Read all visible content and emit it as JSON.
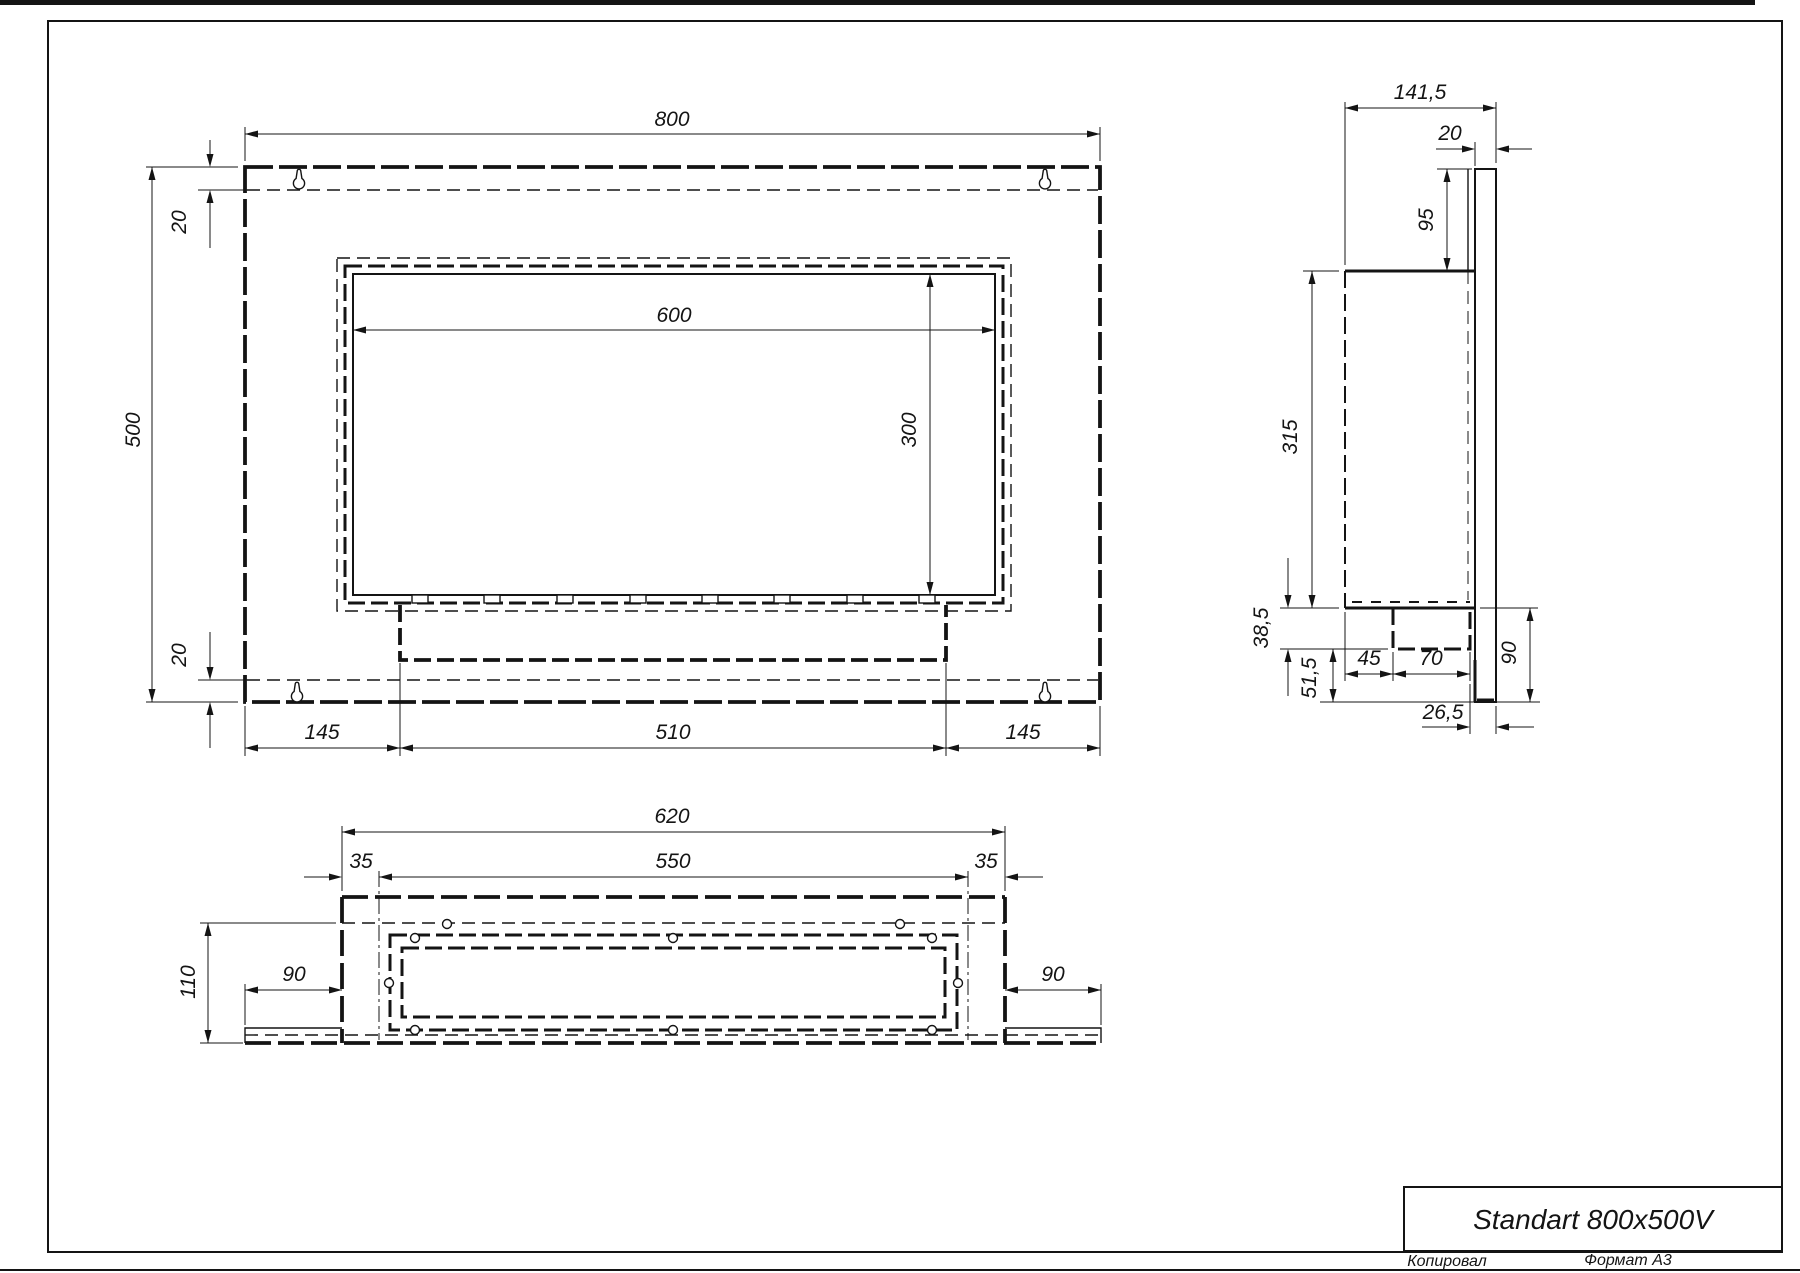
{
  "title_block": {
    "title": "Standart 800x500V"
  },
  "footer": {
    "copied_label": "Копировал",
    "format_label": "Формат А3"
  },
  "front_view": {
    "dims": {
      "overall_width": "800",
      "overall_height": "500",
      "top_flange": "20",
      "bottom_flange": "20",
      "opening_width": "600",
      "opening_height": "300",
      "left_margin": "145",
      "burner_slot_width": "510",
      "right_margin": "145"
    }
  },
  "side_view": {
    "dims": {
      "overall_depth": "141,5",
      "plate_thickness": "20",
      "top_to_body": "95",
      "body_height": "315",
      "tray_drop": "38,5",
      "tray_to_bottom": "51,5",
      "front_to_tray": "45",
      "tray_depth": "70",
      "tray_to_wall": "26,5",
      "lower_plate_height": "90"
    }
  },
  "bottom_view": {
    "dims": {
      "box_width": "620",
      "tray_width": "550",
      "left_inset": "35",
      "right_inset": "35",
      "depth": "110",
      "left_flange": "90",
      "right_flange": "90"
    }
  }
}
